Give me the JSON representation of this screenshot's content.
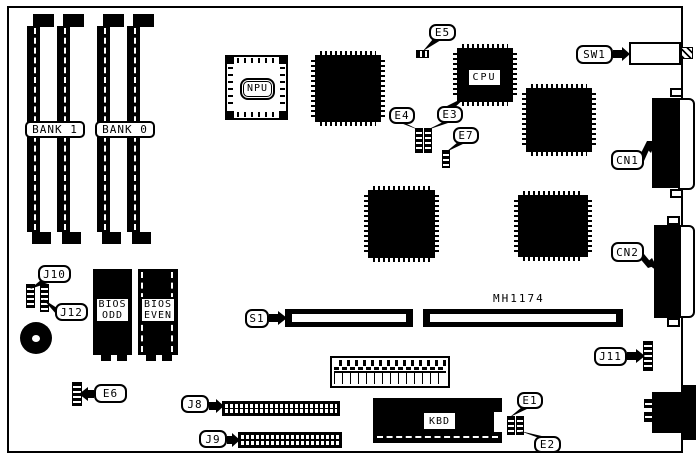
{
  "board": {
    "memory": {
      "bank1_label": "BANK 1",
      "bank0_label": "BANK 0"
    },
    "chips": {
      "npu": "NPU",
      "cpu": "CPU",
      "kbd": "KBD",
      "bios_odd": [
        "BIOS",
        "ODD"
      ],
      "bios_even": [
        "BIOS",
        "EVEN"
      ],
      "part_number": "MH1174"
    },
    "callouts": {
      "e1": "E1",
      "e2": "E2",
      "e3": "E3",
      "e4": "E4",
      "e5": "E5",
      "e6": "E6",
      "e7": "E7",
      "j8": "J8",
      "j9": "J9",
      "j10": "J10",
      "j11": "J11",
      "j12": "J12",
      "s1": "S1",
      "sw1": "SW1",
      "cn1": "CN1",
      "cn2": "CN2"
    },
    "colors": {
      "ink": "#000000",
      "paper": "#ffffff"
    }
  }
}
